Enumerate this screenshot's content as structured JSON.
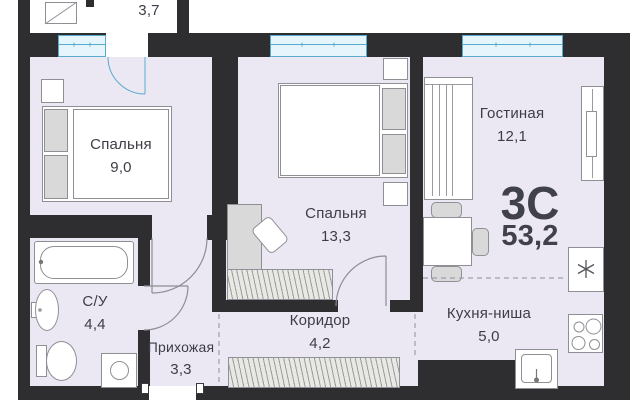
{
  "plan": {
    "apartment": {
      "type_label": "3С",
      "total_area": "53,2"
    },
    "rooms": {
      "balcony": {
        "area": "3,7"
      },
      "bedroom_small": {
        "name": "Спальня",
        "area": "9,0"
      },
      "bedroom_large": {
        "name": "Спальня",
        "area": "13,3"
      },
      "living": {
        "name": "Гостиная",
        "area": "12,1"
      },
      "bathroom": {
        "name": "С/У",
        "area": "4,4"
      },
      "hallway": {
        "name": "Прихожая",
        "area": "3,3"
      },
      "corridor": {
        "name": "Коридор",
        "area": "4,2"
      },
      "kitchen_niche": {
        "name": "Кухня-ниша",
        "area": "5,0"
      }
    },
    "icons": {
      "fridge_defrost_symbol": "✳"
    },
    "colors": {
      "wall": "#2e2e30",
      "floor": "#ece8f3",
      "window_line": "#57abcd",
      "window_fill": "#e6f4fb",
      "furniture_outline": "#8f8f96",
      "text": "#3d3d47",
      "dashed_divider": "#9aa0ae"
    }
  }
}
